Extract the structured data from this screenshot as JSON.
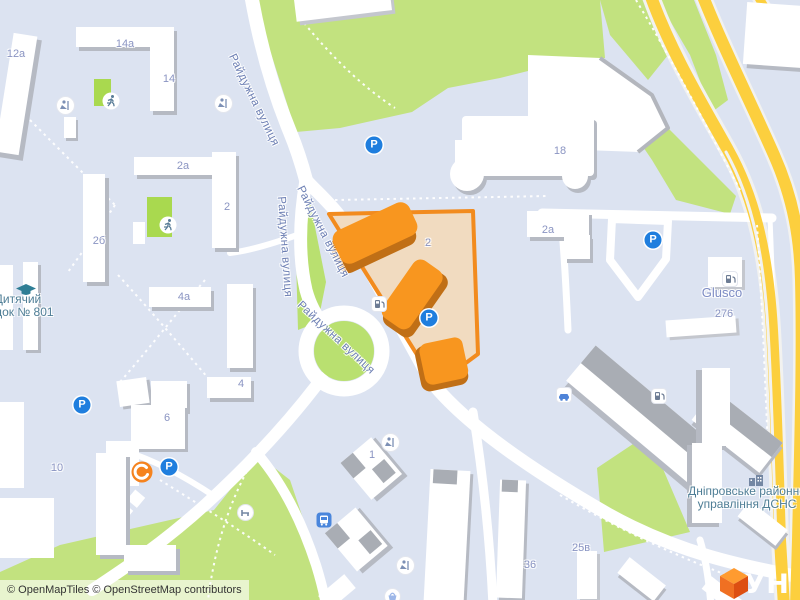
{
  "map": {
    "street_labels": [
      {
        "text": "Райдужна вулиця",
        "x": 237,
        "y": 52,
        "rot": 64
      },
      {
        "text": "Райдужна вулиця",
        "x": 287,
        "y": 196,
        "rot": 86
      },
      {
        "text": "Райдужна вулиця",
        "x": 305,
        "y": 184,
        "rot": 63
      },
      {
        "text": "Райдужна вулиця",
        "x": 303,
        "y": 299,
        "rot": 43
      }
    ],
    "housenumbers": [
      {
        "text": "12а",
        "x": 16,
        "y": 54
      },
      {
        "text": "14а",
        "x": 125,
        "y": 44
      },
      {
        "text": "14",
        "x": 169,
        "y": 79
      },
      {
        "text": "2а",
        "x": 183,
        "y": 166
      },
      {
        "text": "2",
        "x": 227,
        "y": 207
      },
      {
        "text": "2б",
        "x": 99,
        "y": 241
      },
      {
        "text": "4а",
        "x": 184,
        "y": 297
      },
      {
        "text": "4",
        "x": 241,
        "y": 384
      },
      {
        "text": "6",
        "x": 167,
        "y": 418
      },
      {
        "text": "10",
        "x": 57,
        "y": 468
      },
      {
        "text": "2",
        "x": 428,
        "y": 243
      },
      {
        "text": "2а",
        "x": 548,
        "y": 230
      },
      {
        "text": "18",
        "x": 560,
        "y": 151
      },
      {
        "text": "276",
        "x": 724,
        "y": 314
      },
      {
        "text": "1",
        "x": 372,
        "y": 455
      },
      {
        "text": "36",
        "x": 530,
        "y": 565
      },
      {
        "text": "25в",
        "x": 581,
        "y": 548
      }
    ],
    "poi_labels": [
      {
        "name": "glusco-station",
        "style": "shop",
        "lines": [
          "Glusco"
        ],
        "x": 722,
        "y": 286
      },
      {
        "name": "kindergarten",
        "style": "amenity",
        "lines": [
          "Дитячий",
          "садок № 801"
        ],
        "x": 18,
        "y": 293
      },
      {
        "name": "dsns-office",
        "style": "amenity",
        "lines": [
          "Дніпровське районне",
          "управління ДСНС"
        ],
        "x": 747,
        "y": 485
      }
    ],
    "icons": [
      {
        "type": "parking",
        "x": 374,
        "y": 145
      },
      {
        "type": "parking",
        "x": 653,
        "y": 240
      },
      {
        "type": "parking",
        "x": 429,
        "y": 318
      },
      {
        "type": "parking",
        "x": 82,
        "y": 405
      },
      {
        "type": "parking",
        "x": 169,
        "y": 467
      },
      {
        "type": "fuel",
        "x": 371,
        "y": 296
      },
      {
        "type": "fuel",
        "x": 722,
        "y": 271
      },
      {
        "type": "fuel",
        "x": 651,
        "y": 388
      },
      {
        "type": "carwash",
        "x": 556,
        "y": 387
      },
      {
        "type": "bus",
        "x": 316,
        "y": 512
      },
      {
        "type": "bench",
        "x": 237,
        "y": 504
      },
      {
        "type": "basket",
        "x": 384,
        "y": 588
      },
      {
        "type": "playground",
        "x": 56,
        "y": 96
      },
      {
        "type": "playground",
        "x": 214,
        "y": 94
      },
      {
        "type": "playground",
        "x": 381,
        "y": 433
      },
      {
        "type": "playground",
        "x": 396,
        "y": 556
      },
      {
        "type": "sports",
        "x": 102,
        "y": 92
      },
      {
        "type": "sports",
        "x": 159,
        "y": 216
      },
      {
        "type": "school-cap",
        "x": 16,
        "y": 284
      },
      {
        "type": "office-building",
        "x": 748,
        "y": 474
      },
      {
        "type": "brand-marker",
        "x": 131,
        "y": 461
      }
    ],
    "colors": {
      "background": "#dce3f1",
      "park_green": "#c2e27f",
      "pitch_green": "#a9d94f",
      "road_white": "#ffffff",
      "highway_yellow": "#fccf3e",
      "parcel_fill": "#f1dbc0",
      "parcel_border": "#f28b1e",
      "highlight_building": "#f8961f",
      "parking_blue": "#1f7ede",
      "logo_orange": "#f97316"
    }
  },
  "attribution": {
    "text": "© OpenMapTiles © OpenStreetMap contributors"
  },
  "logo": {
    "text": "ЛУН"
  }
}
